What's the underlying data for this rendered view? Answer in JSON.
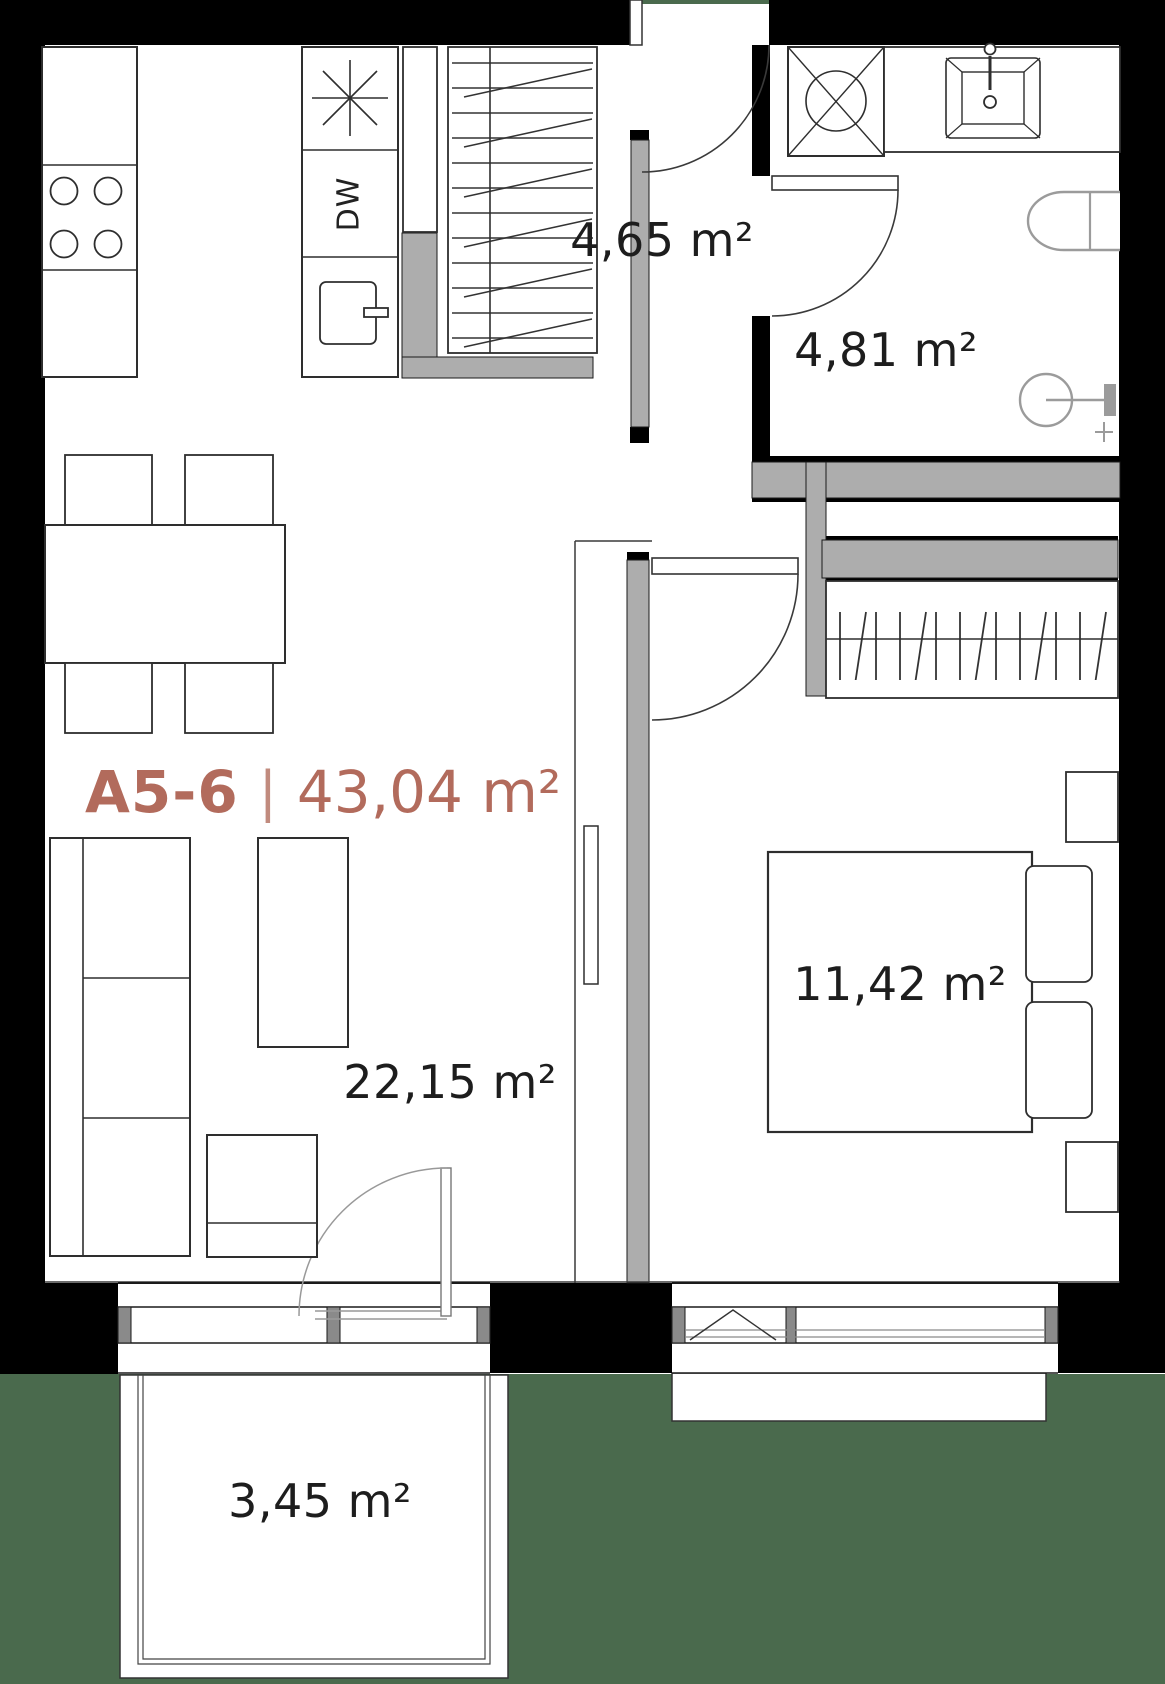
{
  "plan": {
    "title": {
      "unit": "A5-6",
      "separator": "|",
      "area": "43,04 m²"
    },
    "rooms": [
      {
        "name": "hallway",
        "area": "4,65 m²"
      },
      {
        "name": "bathroom",
        "area": "4,81 m²"
      },
      {
        "name": "living-kitchen",
        "area": "22,15 m²"
      },
      {
        "name": "bedroom",
        "area": "11,42 m²"
      },
      {
        "name": "balcony",
        "area": "3,45 m²"
      }
    ],
    "kitchen": {
      "dishwasher": "DW"
    },
    "colors": {
      "walls": "#000000",
      "partitions": "#adadad",
      "outside_ground": "#4a6a4d",
      "accent": "#b26b5c",
      "label_text": "#1d1d1d"
    }
  }
}
